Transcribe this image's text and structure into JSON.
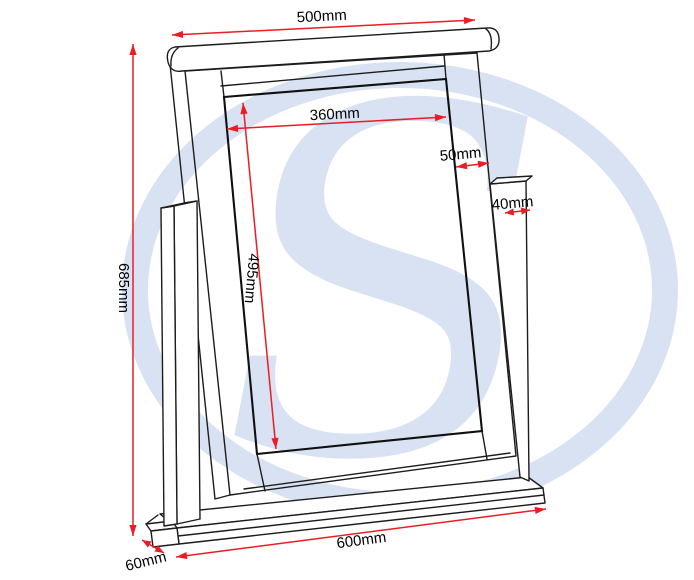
{
  "diagram": {
    "kind": "mirror-dimension-line-drawing"
  },
  "dimensions": {
    "rail_width": "500mm",
    "glass_width": "360mm",
    "frame_side_width": "50mm",
    "post_width": "40mm",
    "overall_height": "685mm",
    "glass_height": "495mm",
    "base_width": "600mm",
    "base_depth": "60mm"
  },
  "watermark": {
    "letter": "S"
  },
  "colors": {
    "dimension_accent": "#ec1c24",
    "outline": "#1c1c1c",
    "watermark_blue": "#d9e2f3",
    "label_text": "#000000",
    "background": "#ffffff"
  }
}
